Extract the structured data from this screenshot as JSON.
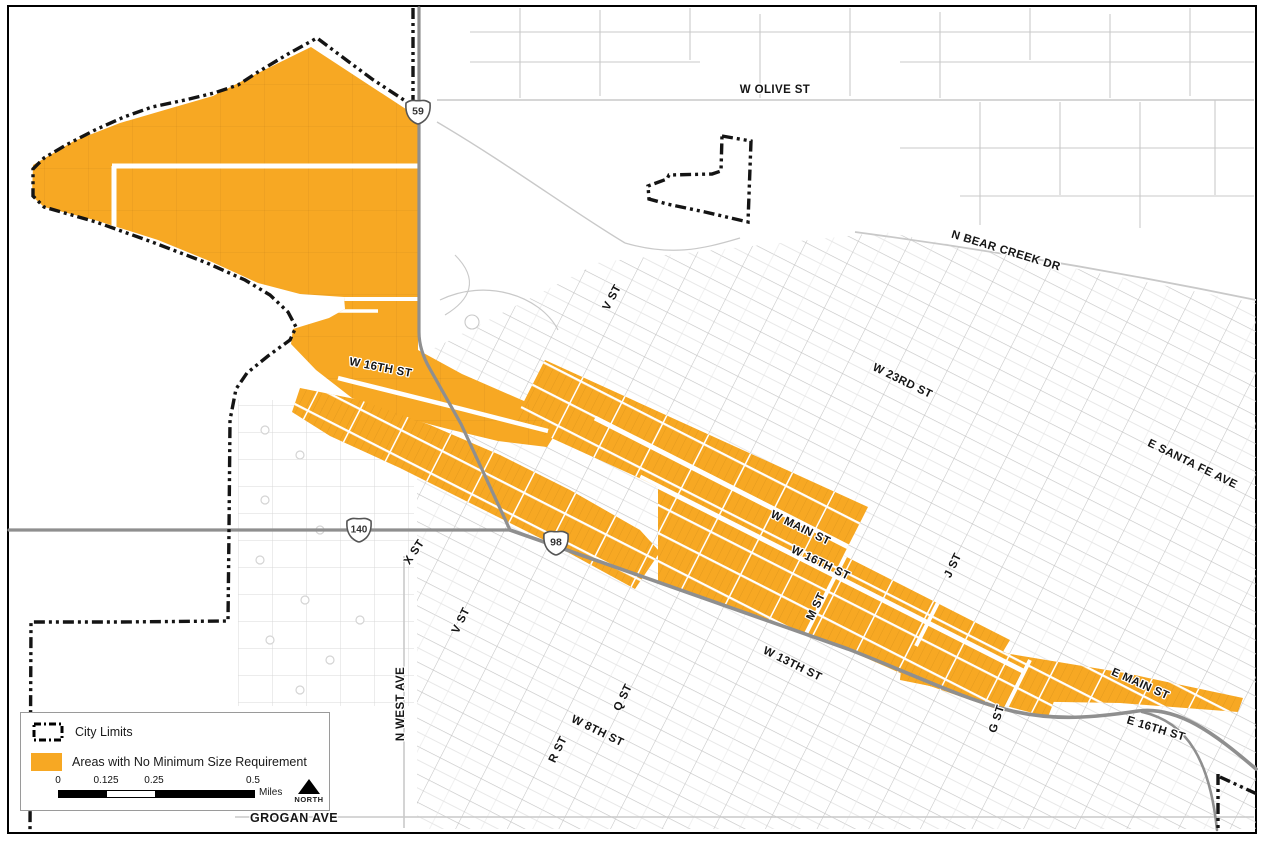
{
  "colors": {
    "area_orange": "#F7A823",
    "road_gray": "#8F8F8F",
    "street_gray": "#C9C9C9",
    "boundary_black": "#141414"
  },
  "legend": {
    "items": [
      {
        "label": "City Limits",
        "symbol": "city-limits-dash"
      },
      {
        "label": "Areas with No Minimum Size Requirement",
        "symbol": "orange-area"
      }
    ]
  },
  "scale_bar": {
    "tick_labels": [
      "0",
      "0.125",
      "0.25",
      "0.5"
    ],
    "unit_label": "Miles"
  },
  "north_arrow": {
    "label": "NORTH"
  },
  "shields": [
    {
      "number": "59"
    },
    {
      "number": "140"
    },
    {
      "number": "98"
    }
  ],
  "street_labels": [
    {
      "text": "W OLIVE ST"
    },
    {
      "text": "N BEAR CREEK DR"
    },
    {
      "text": "V ST"
    },
    {
      "text": "W 23RD ST"
    },
    {
      "text": "E SANTA FE AVE"
    },
    {
      "text": "W 16TH ST"
    },
    {
      "text": "W MAIN ST"
    },
    {
      "text": "W 16TH ST"
    },
    {
      "text": "M ST"
    },
    {
      "text": "J ST"
    },
    {
      "text": "X ST"
    },
    {
      "text": "V ST"
    },
    {
      "text": "W 13TH ST"
    },
    {
      "text": "Q ST"
    },
    {
      "text": "W 8TH ST"
    },
    {
      "text": "R ST"
    },
    {
      "text": "N WEST AVE"
    },
    {
      "text": "GROGAN AVE"
    },
    {
      "text": "E MAIN ST"
    },
    {
      "text": "G ST"
    },
    {
      "text": "E 16TH ST"
    }
  ]
}
